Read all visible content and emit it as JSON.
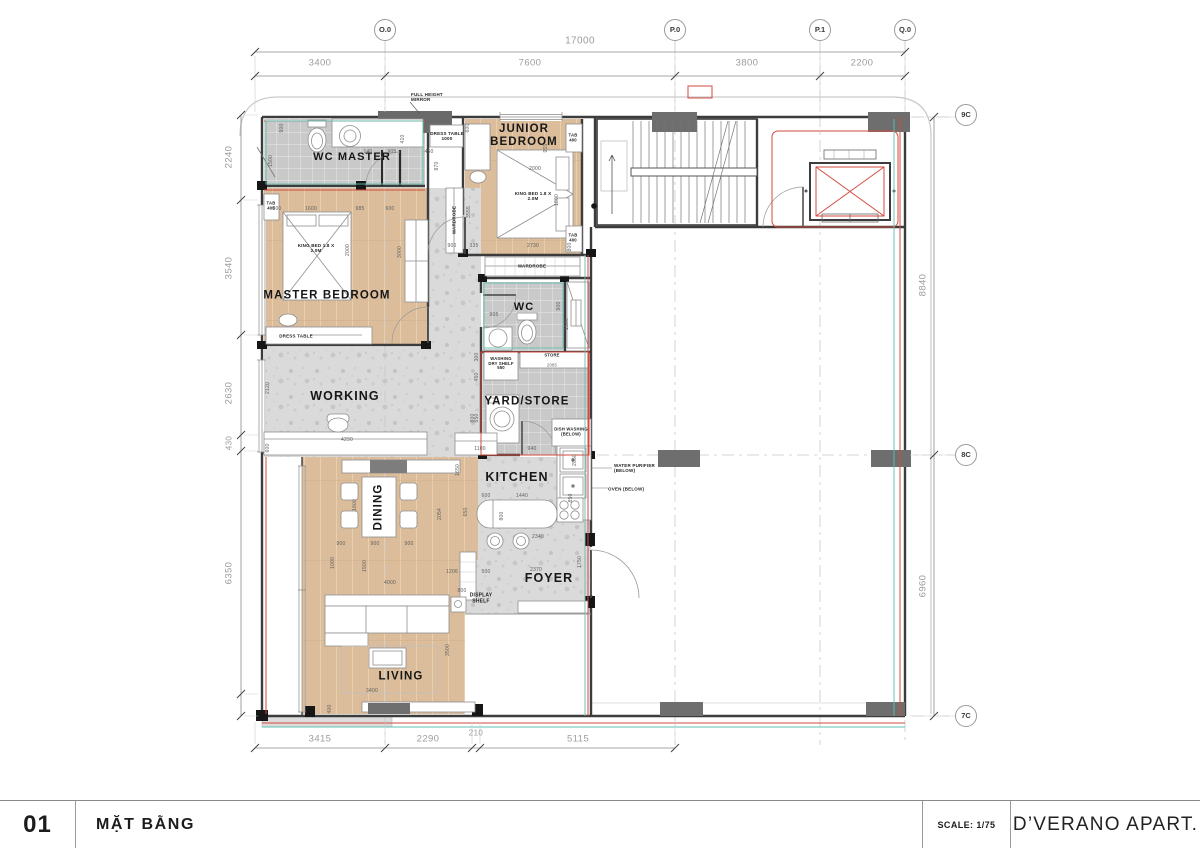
{
  "title_block": {
    "number": "01",
    "title": "MẶT BẰNG",
    "scale": "SCALE: 1/75",
    "project": "D’VERANO APART."
  },
  "grid": {
    "top": [
      "O.0",
      "P.0",
      "P.1",
      "Q.0"
    ],
    "right": [
      "9C",
      "8C",
      "7C"
    ]
  },
  "colors": {
    "wood": "#dcbd9b",
    "tile": "#c9c9c9",
    "terrazzo": "#dadada",
    "wall": "#3c3c3c",
    "column": "#6e6e6e",
    "red_line": "#d24b3f",
    "teal_line": "#5fc0b0",
    "dim_text": "#9c9c9c"
  },
  "placed_labels": [
    {
      "t": "O.0",
      "x": 385,
      "y": 30,
      "fs": 7.5,
      "cls": "bub",
      "n": "grid-bubble-o0"
    },
    {
      "t": "P.0",
      "x": 675,
      "y": 30,
      "fs": 7.5,
      "cls": "bub",
      "n": "grid-bubble-p0"
    },
    {
      "t": "P.1",
      "x": 820,
      "y": 30,
      "fs": 7.5,
      "cls": "bub",
      "n": "grid-bubble-p1"
    },
    {
      "t": "Q.0",
      "x": 905,
      "y": 30,
      "fs": 7.5,
      "cls": "bub",
      "n": "grid-bubble-q0"
    },
    {
      "t": "9C",
      "x": 966,
      "y": 115,
      "fs": 7.5,
      "cls": "bub",
      "n": "grid-bubble-9c"
    },
    {
      "t": "8C",
      "x": 966,
      "y": 455,
      "fs": 7.5,
      "cls": "bub",
      "n": "grid-bubble-8c"
    },
    {
      "t": "7C",
      "x": 966,
      "y": 716,
      "fs": 7.5,
      "cls": "bub",
      "n": "grid-bubble-7c"
    },
    {
      "t": "17000",
      "x": 580,
      "y": 41,
      "fs": 10,
      "cls": "dim",
      "n": "dim-top-total"
    },
    {
      "t": "3400",
      "x": 320,
      "y": 64,
      "fs": 9.5,
      "cls": "dim"
    },
    {
      "t": "7600",
      "x": 530,
      "y": 64,
      "fs": 9.5,
      "cls": "dim"
    },
    {
      "t": "3800",
      "x": 747,
      "y": 64,
      "fs": 9.5,
      "cls": "dim"
    },
    {
      "t": "2200",
      "x": 862,
      "y": 64,
      "fs": 9.5,
      "cls": "dim"
    },
    {
      "t": "2240",
      "x": 230,
      "y": 157,
      "fs": 9.5,
      "cls": "dim",
      "rot": -90
    },
    {
      "t": "3540",
      "x": 230,
      "y": 268,
      "fs": 9.5,
      "cls": "dim",
      "rot": -90
    },
    {
      "t": "2630",
      "x": 230,
      "y": 393,
      "fs": 9.5,
      "cls": "dim",
      "rot": -90
    },
    {
      "t": "430",
      "x": 230,
      "y": 443,
      "fs": 8,
      "cls": "dim",
      "rot": -90
    },
    {
      "t": "6350",
      "x": 230,
      "y": 573,
      "fs": 9.5,
      "cls": "dim",
      "rot": -90
    },
    {
      "t": "8840",
      "x": 924,
      "y": 285,
      "fs": 9.5,
      "cls": "dim",
      "rot": -90
    },
    {
      "t": "6960",
      "x": 924,
      "y": 586,
      "fs": 9.5,
      "cls": "dim",
      "rot": -90
    },
    {
      "t": "3415",
      "x": 320,
      "y": 740,
      "fs": 9.5,
      "cls": "dim"
    },
    {
      "t": "2290",
      "x": 428,
      "y": 740,
      "fs": 9.5,
      "cls": "dim"
    },
    {
      "t": "210",
      "x": 476,
      "y": 734,
      "fs": 8,
      "cls": "dim"
    },
    {
      "t": "5115",
      "x": 578,
      "y": 740,
      "fs": 9.5,
      "cls": "dim"
    },
    {
      "t": "WC MASTER",
      "x": 352,
      "y": 157,
      "fs": 11,
      "cls": "room",
      "n": "room-label-wc-master"
    },
    {
      "t": "JUNIOR BEDROOM",
      "x": 524,
      "y": 136,
      "fs": 11.5,
      "cls": "room",
      "w": 92,
      "n": "room-label-junior-bedroom"
    },
    {
      "t": "MASTER BEDROOM",
      "x": 327,
      "y": 296,
      "fs": 11.5,
      "cls": "room",
      "n": "room-label-master-bedroom"
    },
    {
      "t": "WORKING",
      "x": 345,
      "y": 396,
      "fs": 12.5,
      "cls": "room",
      "n": "room-label-working"
    },
    {
      "t": "WC",
      "x": 524,
      "y": 307,
      "fs": 11,
      "cls": "room",
      "n": "room-label-wc"
    },
    {
      "t": "YARD/STORE",
      "x": 527,
      "y": 402,
      "fs": 11.5,
      "cls": "room",
      "n": "room-label-yard-store"
    },
    {
      "t": "KITCHEN",
      "x": 517,
      "y": 477,
      "fs": 12.5,
      "cls": "room",
      "n": "room-label-kitchen"
    },
    {
      "t": "DINING",
      "x": 379,
      "y": 507,
      "fs": 11.5,
      "cls": "room",
      "rot": -90,
      "n": "room-label-dining"
    },
    {
      "t": "FOYER",
      "x": 549,
      "y": 578,
      "fs": 12.5,
      "cls": "room",
      "n": "room-label-foyer"
    },
    {
      "t": "LIVING",
      "x": 401,
      "y": 677,
      "fs": 11.5,
      "cls": "room",
      "n": "room-label-living"
    },
    {
      "t": "FULL HEIGHT MIRROR",
      "x": 434,
      "y": 97,
      "fs": 4.5,
      "cls": "ann",
      "w": 46,
      "al": "left",
      "n": "note-full-height-mirror"
    },
    {
      "t": "DRESS TABLE",
      "x": 296,
      "y": 336,
      "fs": 4.5,
      "cls": "ann",
      "n": "note-dress-table-master"
    },
    {
      "t": "DRESS TABLE 1000",
      "x": 447,
      "y": 136,
      "fs": 4.5,
      "cls": "ann",
      "w": 34,
      "n": "note-dress-table-junior"
    },
    {
      "t": "KING BED 1.8 X 2.0M",
      "x": 316,
      "y": 248,
      "fs": 4.5,
      "cls": "ann",
      "w": 42,
      "n": "note-king-bed-master"
    },
    {
      "t": "KING BED 1.8 X 2.0M",
      "x": 533,
      "y": 196,
      "fs": 4.5,
      "cls": "ann",
      "w": 42,
      "n": "note-king-bed-junior"
    },
    {
      "t": "TAB 400",
      "x": 271,
      "y": 206,
      "fs": 4.2,
      "cls": "ann",
      "w": 15
    },
    {
      "t": "TAB 400",
      "x": 573,
      "y": 138,
      "fs": 4.2,
      "cls": "ann",
      "w": 15
    },
    {
      "t": "TAB 400",
      "x": 573,
      "y": 238,
      "fs": 4.2,
      "cls": "ann",
      "w": 15
    },
    {
      "t": "WARDROBE",
      "x": 454,
      "y": 220,
      "fs": 4.5,
      "cls": "ann",
      "rot": -90,
      "n": "note-wardrobe-column"
    },
    {
      "t": "WARDROBE",
      "x": 532,
      "y": 266,
      "fs": 4.5,
      "cls": "ann",
      "n": "note-wardrobe-strip"
    },
    {
      "t": "WASHING DRY SHELF 550",
      "x": 501,
      "y": 364,
      "fs": 4.2,
      "cls": "ann",
      "w": 32,
      "n": "note-washing-dry-shelf"
    },
    {
      "t": "STORE",
      "x": 552,
      "y": 356,
      "fs": 4.2,
      "cls": "ann"
    },
    {
      "t": "2085",
      "x": 552,
      "y": 366,
      "fs": 4.2,
      "cls": "dimS"
    },
    {
      "t": "DISH WASHING (BELOW)",
      "x": 571,
      "y": 432,
      "fs": 4.2,
      "cls": "ann",
      "w": 34,
      "n": "note-dish-washing"
    },
    {
      "t": "WATER PURIFIER (BELOW)",
      "x": 641,
      "y": 468,
      "fs": 4.5,
      "cls": "ann",
      "w": 54,
      "al": "left",
      "n": "note-water-purifier"
    },
    {
      "t": "OVEN (BELOW)",
      "x": 628,
      "y": 489,
      "fs": 4.5,
      "cls": "ann",
      "w": 40,
      "al": "left",
      "n": "note-oven"
    },
    {
      "t": "DISPLAY SHELF",
      "x": 481,
      "y": 599,
      "fs": 5,
      "cls": "ann",
      "w": 28,
      "n": "note-display-shelf"
    },
    {
      "t": "900",
      "x": 283,
      "y": 128,
      "rot": -90
    },
    {
      "t": "1500",
      "x": 272,
      "y": 161,
      "rot": -90
    },
    {
      "t": "140",
      "x": 368,
      "y": 153
    },
    {
      "t": "905",
      "x": 392,
      "y": 153
    },
    {
      "t": "410",
      "x": 404,
      "y": 139,
      "rot": -90
    },
    {
      "t": "450",
      "x": 429,
      "y": 153
    },
    {
      "t": "870",
      "x": 438,
      "y": 166,
      "rot": -90
    },
    {
      "t": "800",
      "x": 277,
      "y": 210
    },
    {
      "t": "1600",
      "x": 311,
      "y": 210
    },
    {
      "t": "985",
      "x": 360,
      "y": 210
    },
    {
      "t": "600",
      "x": 390,
      "y": 210
    },
    {
      "t": "2000",
      "x": 349,
      "y": 250,
      "rot": -90
    },
    {
      "t": "3000",
      "x": 401,
      "y": 252,
      "rot": -90
    },
    {
      "t": "600",
      "x": 469,
      "y": 128,
      "rot": -90
    },
    {
      "t": "2000",
      "x": 535,
      "y": 170
    },
    {
      "t": "955",
      "x": 547,
      "y": 148,
      "rot": -90
    },
    {
      "t": "1800",
      "x": 558,
      "y": 200,
      "rot": -90
    },
    {
      "t": "3555",
      "x": 470,
      "y": 212,
      "rot": -90
    },
    {
      "t": "900",
      "x": 452,
      "y": 247
    },
    {
      "t": "335",
      "x": 474,
      "y": 247
    },
    {
      "t": "2730",
      "x": 533,
      "y": 247
    },
    {
      "t": "800",
      "x": 571,
      "y": 247,
      "rot": -90
    },
    {
      "t": "2120",
      "x": 269,
      "y": 388,
      "rot": -90
    },
    {
      "t": "4290",
      "x": 347,
      "y": 441
    },
    {
      "t": "600",
      "x": 269,
      "y": 448,
      "rot": -90
    },
    {
      "t": "800",
      "x": 474,
      "y": 418,
      "rot": -90
    },
    {
      "t": "905",
      "x": 494,
      "y": 316
    },
    {
      "t": "900",
      "x": 560,
      "y": 306,
      "rot": -90
    },
    {
      "t": "1500",
      "x": 568,
      "y": 324,
      "rot": -90
    },
    {
      "t": "300",
      "x": 478,
      "y": 357,
      "rot": -90
    },
    {
      "t": "450",
      "x": 478,
      "y": 377,
      "rot": -90
    },
    {
      "t": "650",
      "x": 478,
      "y": 418,
      "rot": -90
    },
    {
      "t": "1100",
      "x": 480,
      "y": 450
    },
    {
      "t": "940",
      "x": 532,
      "y": 450
    },
    {
      "t": "2050",
      "x": 576,
      "y": 460,
      "rot": -90
    },
    {
      "t": "600",
      "x": 486,
      "y": 497
    },
    {
      "t": "1440",
      "x": 522,
      "y": 497
    },
    {
      "t": "850",
      "x": 572,
      "y": 498,
      "rot": -90
    },
    {
      "t": "650",
      "x": 467,
      "y": 512,
      "rot": -90
    },
    {
      "t": "800",
      "x": 503,
      "y": 516,
      "rot": -90
    },
    {
      "t": "2340",
      "x": 538,
      "y": 538
    },
    {
      "t": "2054",
      "x": 441,
      "y": 514,
      "rot": -90
    },
    {
      "t": "1650",
      "x": 459,
      "y": 470,
      "rot": -90
    },
    {
      "t": "1206",
      "x": 452,
      "y": 573
    },
    {
      "t": "500",
      "x": 486,
      "y": 573
    },
    {
      "t": "2370",
      "x": 536,
      "y": 571
    },
    {
      "t": "1750",
      "x": 581,
      "y": 562,
      "rot": -90
    },
    {
      "t": "900",
      "x": 341,
      "y": 545
    },
    {
      "t": "900",
      "x": 375,
      "y": 545
    },
    {
      "t": "900",
      "x": 409,
      "y": 545
    },
    {
      "t": "1800",
      "x": 356,
      "y": 505,
      "rot": -90
    },
    {
      "t": "1500",
      "x": 366,
      "y": 566,
      "rot": -90
    },
    {
      "t": "1000",
      "x": 334,
      "y": 563,
      "rot": -90
    },
    {
      "t": "4000",
      "x": 390,
      "y": 584
    },
    {
      "t": "800",
      "x": 462,
      "y": 592
    },
    {
      "t": "3400",
      "x": 372,
      "y": 692
    },
    {
      "t": "3500",
      "x": 449,
      "y": 650,
      "rot": -90
    },
    {
      "t": "400",
      "x": 331,
      "y": 709,
      "rot": -90
    }
  ]
}
